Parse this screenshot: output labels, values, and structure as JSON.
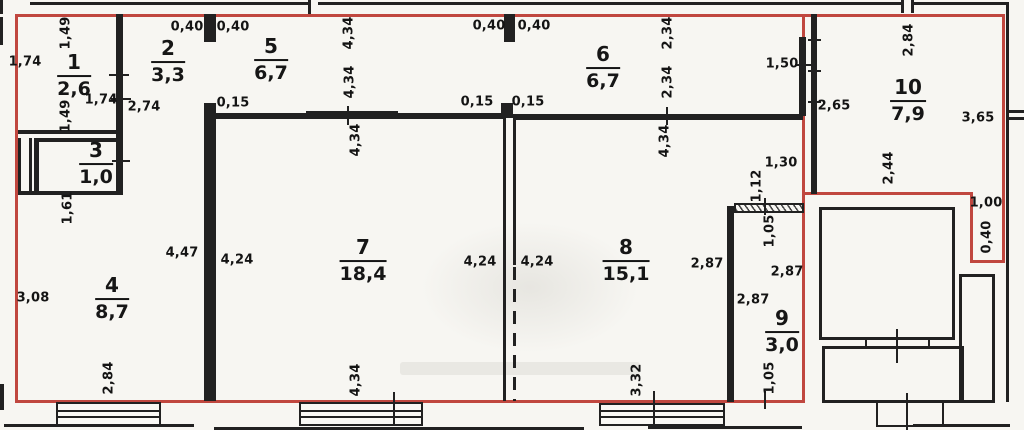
{
  "plan": {
    "description": "Apartment floor plan with numbered rooms (area in sq.m) and wall dimensions in meters",
    "colors": {
      "boundary_red": "#c0473f",
      "wall_black": "#212121",
      "paper": "#f7f6f2"
    }
  },
  "rooms": [
    {
      "number": "1",
      "area": "2,6",
      "x": 74,
      "y": 76
    },
    {
      "number": "2",
      "area": "3,3",
      "x": 168,
      "y": 62
    },
    {
      "number": "3",
      "area": "1,0",
      "x": 96,
      "y": 164
    },
    {
      "number": "4",
      "area": "8,7",
      "x": 112,
      "y": 299
    },
    {
      "number": "5",
      "area": "6,7",
      "x": 271,
      "y": 60
    },
    {
      "number": "6",
      "area": "6,7",
      "x": 603,
      "y": 68
    },
    {
      "number": "7",
      "area": "18,4",
      "x": 363,
      "y": 261
    },
    {
      "number": "8",
      "area": "15,1",
      "x": 626,
      "y": 261
    },
    {
      "number": "9",
      "area": "3,0",
      "x": 782,
      "y": 332
    },
    {
      "number": "10",
      "area": "7,9",
      "x": 908,
      "y": 101
    }
  ],
  "dimensions": [
    {
      "value": "1,74",
      "x": 25,
      "y": 62
    },
    {
      "value": "1,49",
      "x": 66,
      "y": 33,
      "rotated": true
    },
    {
      "value": "1,49",
      "x": 66,
      "y": 116,
      "rotated": true
    },
    {
      "value": "1,74",
      "x": 101,
      "y": 100
    },
    {
      "value": "2,74",
      "x": 144,
      "y": 107
    },
    {
      "value": "0,40",
      "x": 187,
      "y": 27
    },
    {
      "value": "0,40",
      "x": 233,
      "y": 27
    },
    {
      "value": "0,15",
      "x": 233,
      "y": 103
    },
    {
      "value": "4,34",
      "x": 349,
      "y": 33,
      "rotated": true
    },
    {
      "value": "4,34",
      "x": 350,
      "y": 82,
      "rotated": true
    },
    {
      "value": "4,34",
      "x": 356,
      "y": 140,
      "rotated": true
    },
    {
      "value": "4,34",
      "x": 356,
      "y": 380,
      "rotated": true
    },
    {
      "value": "0,40",
      "x": 489,
      "y": 26
    },
    {
      "value": "0,40",
      "x": 534,
      "y": 26
    },
    {
      "value": "0,15",
      "x": 477,
      "y": 102
    },
    {
      "value": "0,15",
      "x": 528,
      "y": 102
    },
    {
      "value": "2,34",
      "x": 668,
      "y": 33,
      "rotated": true
    },
    {
      "value": "2,34",
      "x": 668,
      "y": 82,
      "rotated": true
    },
    {
      "value": "4,34",
      "x": 665,
      "y": 141,
      "rotated": true
    },
    {
      "value": "1,50",
      "x": 782,
      "y": 64
    },
    {
      "value": "2,84",
      "x": 909,
      "y": 40,
      "rotated": true
    },
    {
      "value": "2,65",
      "x": 834,
      "y": 106
    },
    {
      "value": "3,65",
      "x": 978,
      "y": 118
    },
    {
      "value": "2,44",
      "x": 889,
      "y": 168,
      "rotated": true
    },
    {
      "value": "1,30",
      "x": 781,
      "y": 163
    },
    {
      "value": "1,12",
      "x": 757,
      "y": 186,
      "rotated": true
    },
    {
      "value": "1,00",
      "x": 986,
      "y": 203
    },
    {
      "value": "0,40",
      "x": 987,
      "y": 237,
      "rotated": true
    },
    {
      "value": "1,61",
      "x": 68,
      "y": 208,
      "rotated": true
    },
    {
      "value": "3,08",
      "x": 33,
      "y": 298
    },
    {
      "value": "4,47",
      "x": 182,
      "y": 253
    },
    {
      "value": "4,24",
      "x": 237,
      "y": 260
    },
    {
      "value": "4,24",
      "x": 480,
      "y": 262
    },
    {
      "value": "4,24",
      "x": 537,
      "y": 262
    },
    {
      "value": "2,87",
      "x": 707,
      "y": 264
    },
    {
      "value": "2,87",
      "x": 787,
      "y": 272
    },
    {
      "value": "2,87",
      "x": 753,
      "y": 300
    },
    {
      "value": "1,05",
      "x": 770,
      "y": 231,
      "rotated": true
    },
    {
      "value": "1,05",
      "x": 770,
      "y": 378,
      "rotated": true
    },
    {
      "value": "2,84",
      "x": 109,
      "y": 378,
      "rotated": true
    },
    {
      "value": "3,32",
      "x": 637,
      "y": 380,
      "rotated": true
    }
  ]
}
